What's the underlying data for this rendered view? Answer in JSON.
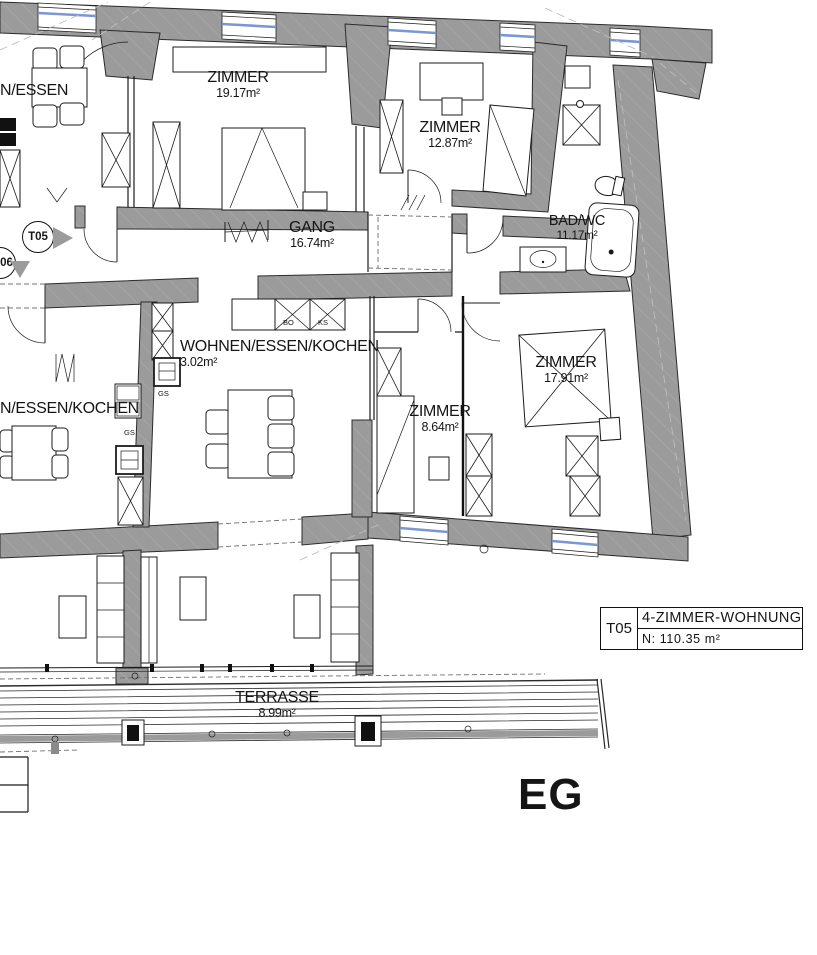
{
  "floor_label": "EG",
  "title_block": {
    "unit": "T05",
    "type": "4-ZIMMER-WOHNUNG",
    "net_area": "N:  110.35  m²"
  },
  "markers": {
    "t05": "T05",
    "t06": "06"
  },
  "rooms": {
    "essen_top": {
      "name": "N/ESSEN",
      "area": ""
    },
    "zimmer1": {
      "name": "ZIMMER",
      "area": "19.17m²"
    },
    "zimmer2": {
      "name": "ZIMMER",
      "area": "12.87m²"
    },
    "bad": {
      "name": "BAD/WC",
      "area": "11.17m²"
    },
    "gang": {
      "name": "GANG",
      "area": "16.74m²"
    },
    "wohnen_mid": {
      "name": "WOHNEN/ESSEN/KOCHEN",
      "area": "3.02m²"
    },
    "wohnen_left": {
      "name": "N/ESSEN/KOCHEN",
      "area": ""
    },
    "zimmer3": {
      "name": "ZIMMER",
      "area": "8.64m²"
    },
    "zimmer4": {
      "name": "ZIMMER",
      "area": "17.91m²"
    },
    "terrasse": {
      "name": "TERRASSE",
      "area": "8.99m²"
    }
  },
  "appliances": {
    "bo": "BO",
    "ks": "KS",
    "gs": "GS"
  },
  "colors": {
    "wall": "#9b9b9b",
    "line": "#1b1b1b",
    "window_glazing": "#7b96d4",
    "paper": "#ffffff"
  }
}
